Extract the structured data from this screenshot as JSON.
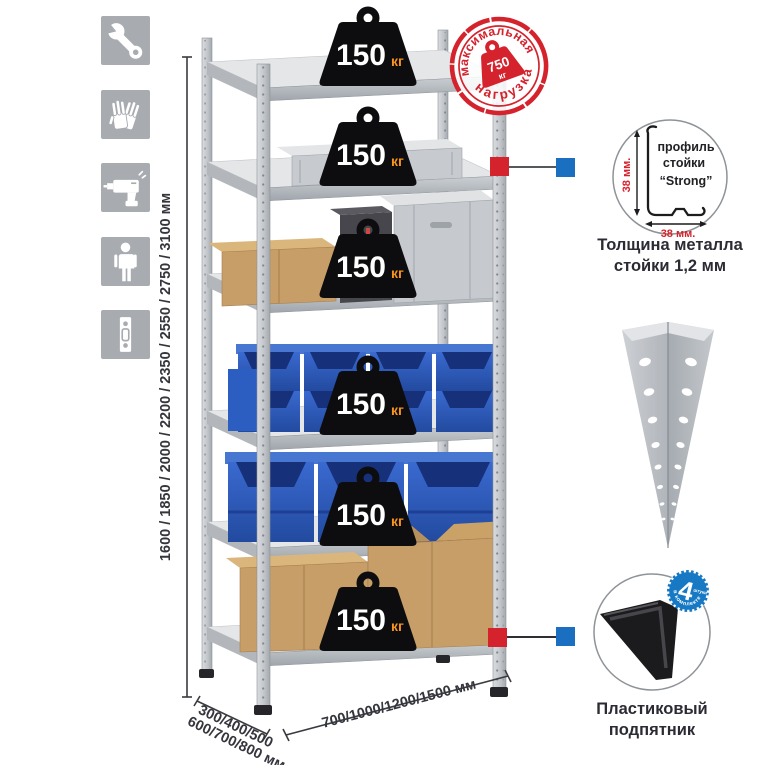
{
  "infographic": {
    "subject": "metal-shelving-rack",
    "colors": {
      "icon_tile_gray": "#a8acb1",
      "stamp_red": "#d5232e",
      "marker_red": "#d5232e",
      "marker_blue": "#1b6fc0",
      "badge_blue": "#1779c4",
      "weight_black": "#0d0d0f",
      "weight_unit_orange": "#f7941e",
      "bin_blue": "#2c5ec2",
      "cardboard_tan": "#c79e67",
      "metal_gray": "#c9ccd0"
    }
  },
  "feature_icons": {
    "items": [
      {
        "icon": "wrench-icon"
      },
      {
        "icon": "gloves-icon"
      },
      {
        "icon": "drill-icon"
      },
      {
        "icon": "person-icon"
      },
      {
        "icon": "perforated-profile-icon"
      }
    ]
  },
  "dimensions": {
    "height_label": "1600 / 1850 / 2000 / 2200 / 2350 / 2550 / 2750 / 3100 мм",
    "depth_label_line1": "300/400/500",
    "depth_label_line2": "600/700/800 мм",
    "width_label": "700/1000/1200/1500 мм"
  },
  "shelf_weight": {
    "value": "150",
    "unit": "кг",
    "count_of_shelves": 6
  },
  "max_load_stamp": {
    "top_text": "максимальная",
    "bottom_text": "нагрузка",
    "value": "750",
    "unit": "кг"
  },
  "profile_detail": {
    "line1": "профиль",
    "line2": "стойки",
    "line3": "“Strong”",
    "dim_vertical": "38 мм.",
    "dim_horizontal": "38 мм.",
    "caption_line1": "Толщина металла",
    "caption_line2": "стойки 1,2 мм"
  },
  "foot_detail": {
    "badge_value": "4",
    "badge_small_text": "штуки",
    "badge_arc_text": "в комплекте",
    "caption_line1": "Пластиковый",
    "caption_line2": "подпятник"
  }
}
